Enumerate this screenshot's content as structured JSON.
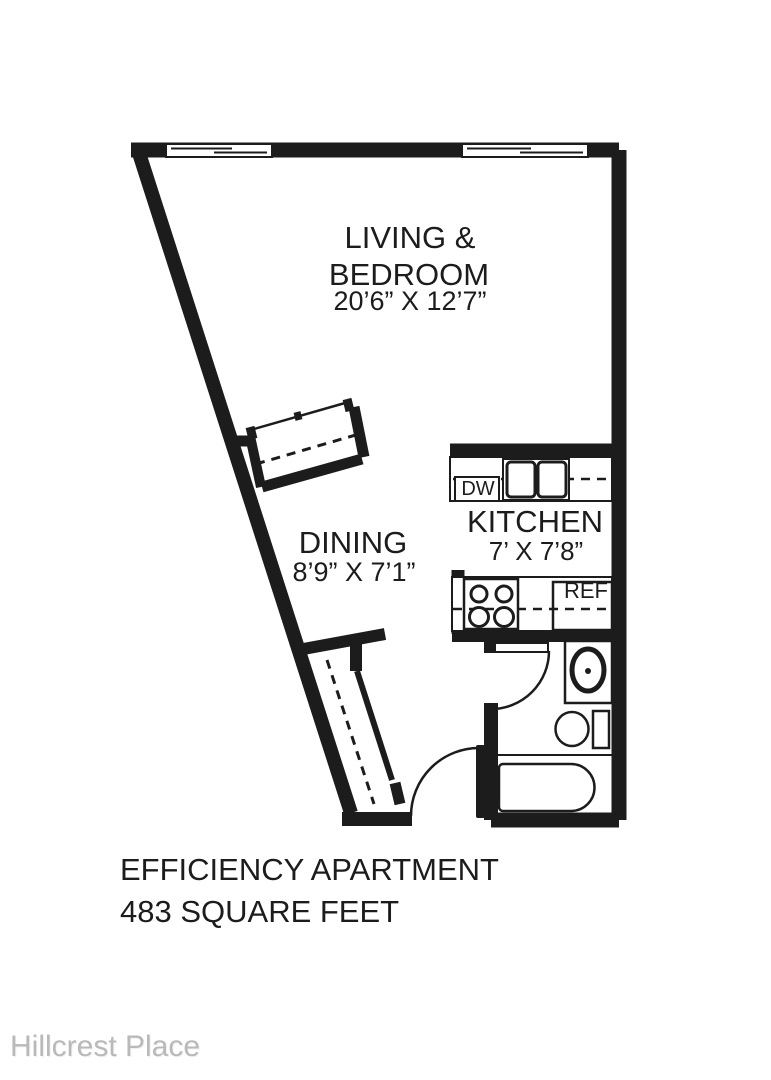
{
  "plan": {
    "living": {
      "line1": "LIVING &",
      "line2": "BEDROOM",
      "dims": "20’6” X 12’7”"
    },
    "dining": {
      "name": "DINING",
      "dims": "8’9” X 7’1”"
    },
    "kitchen": {
      "name": "KITCHEN",
      "dims": "7’ X 7’8”"
    },
    "appliances": {
      "dishwasher": "DW",
      "refrigerator": "REF"
    },
    "footer": {
      "line1": "EFFICIENCY APARTMENT",
      "line2": "483 SQUARE FEET"
    },
    "watermark": "Hillcrest Place",
    "colors": {
      "wall": "#1c1c1c",
      "background": "#ffffff",
      "watermark_text": "#b9b9b9"
    }
  }
}
